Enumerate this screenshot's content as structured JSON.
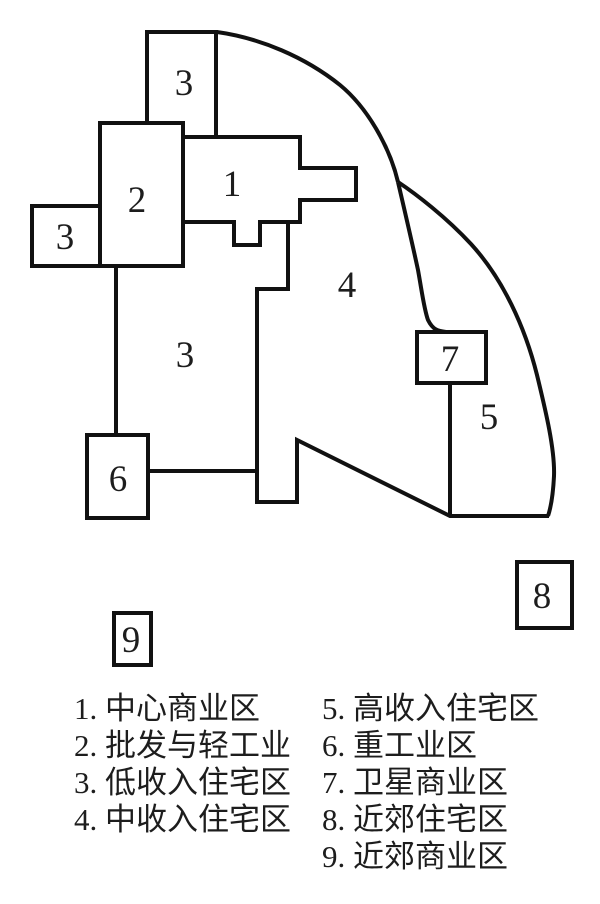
{
  "map": {
    "regions": [
      {
        "id": "region-1",
        "label": "1"
      },
      {
        "id": "region-2",
        "label": "2"
      },
      {
        "id": "region-3-top",
        "label": "3"
      },
      {
        "id": "region-3-left",
        "label": "3"
      },
      {
        "id": "region-3-mid",
        "label": "3"
      },
      {
        "id": "region-4",
        "label": "4"
      },
      {
        "id": "region-5",
        "label": "5"
      },
      {
        "id": "region-6",
        "label": "6"
      },
      {
        "id": "region-7",
        "label": "7"
      },
      {
        "id": "region-8",
        "label": "8"
      },
      {
        "id": "region-9",
        "label": "9"
      }
    ]
  },
  "legend": {
    "left": [
      {
        "label": "1. 中心商业区"
      },
      {
        "label": "2. 批发与轻工业"
      },
      {
        "label": "3. 低收入住宅区"
      },
      {
        "label": "4. 中收入住宅区"
      }
    ],
    "right": [
      {
        "label": "5. 高收入住宅区"
      },
      {
        "label": "6. 重工业区"
      },
      {
        "label": "7. 卫星商业区"
      },
      {
        "label": "8. 近郊住宅区"
      },
      {
        "label": "9. 近郊商业区"
      }
    ]
  },
  "colors": {
    "line": "#111111",
    "text": "#1d1d1d",
    "background": "#ffffff"
  }
}
